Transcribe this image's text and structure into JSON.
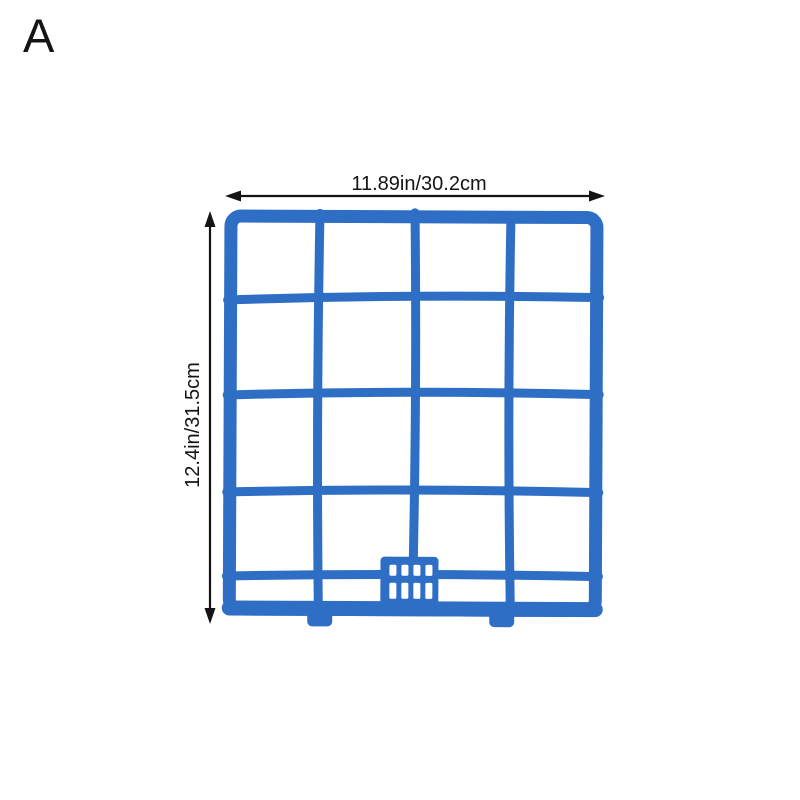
{
  "page": {
    "background_color": "#ffffff",
    "variant_label": "A"
  },
  "diagram": {
    "product": "air-conditioner-filter-grid-frame",
    "frame_color": "#2e6fc5",
    "annotation_color": "#141414",
    "width_label": "11.89in/30.2cm",
    "height_label": "12.4in/31.5cm",
    "grid": {
      "columns": 4,
      "rows": 4
    }
  }
}
